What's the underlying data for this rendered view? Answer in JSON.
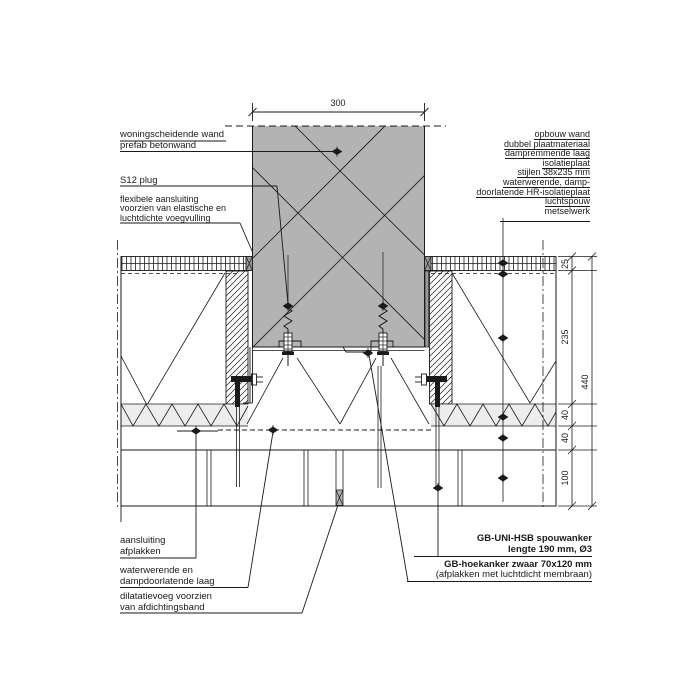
{
  "annotations": {
    "party_wall": [
      "woningscheidende wand",
      "prefab betonwand"
    ],
    "plug": [
      "S12 plug"
    ],
    "flexible_joint": [
      "flexibele aansluiting",
      "voorzien van elastische en",
      "luchtdichte voegvulling"
    ],
    "outer_wall": [
      "opbouw wand",
      "dubbel plaatmateriaal",
      "dampremmende laag",
      "isolatieplaat",
      "stijlen 38x235 mm",
      "waterwerende, damp-",
      "doorlatende HR-isolatieplaat",
      "luchtspouw",
      "metselwerk"
    ],
    "tape_connection": [
      "aansluiting",
      "afplakken"
    ],
    "water_layer": [
      "waterwerende en",
      "dampdoorlatende laag"
    ],
    "dilatation_joint": [
      "dilatatievoeg voorzien",
      "van afdichtingsband"
    ],
    "cavity_tie": [
      "GB-UNI-HSB spouwanker",
      "lengte 190 mm, Ø3"
    ],
    "corner_anchor": [
      "GB-hoekanker zwaar 70x120 mm",
      "(afplakken met luchtdicht membraan)"
    ]
  },
  "dimensions": {
    "wall_width": "300",
    "layer_segments": [
      "25",
      "235",
      "40",
      "40",
      "100"
    ],
    "total": "440"
  },
  "colors": {
    "concrete_fill": "#b3b3b3",
    "insulation_fill": "#ededed",
    "membrane_strip": "#999999",
    "seal_fill": "#b0b0b0",
    "line": "#1a1a1a"
  }
}
